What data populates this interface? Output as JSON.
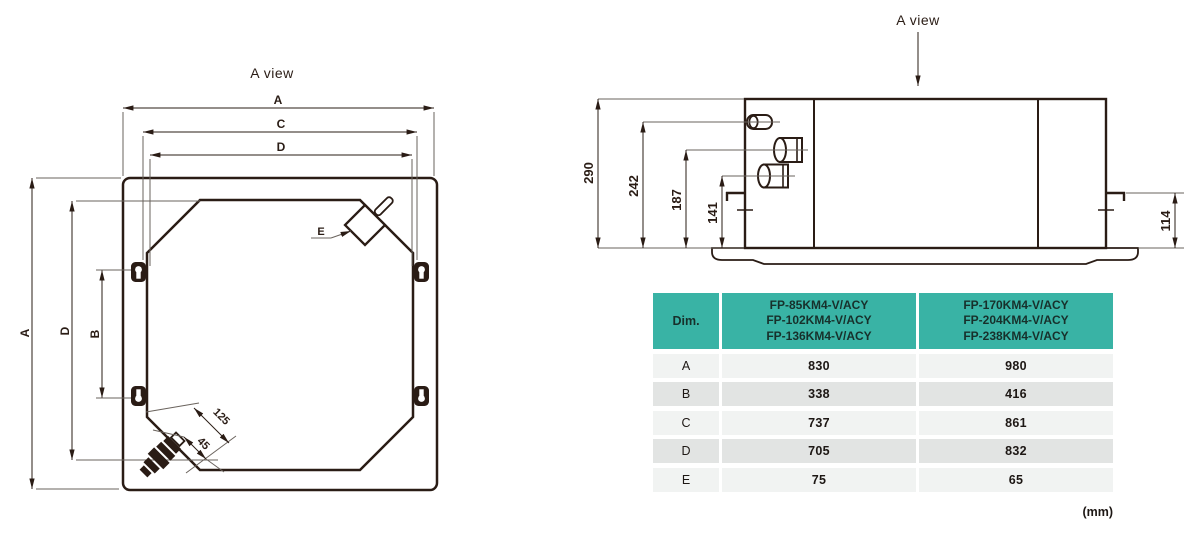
{
  "colors": {
    "line": "#2a1c15",
    "thin": "#6a635d",
    "teal": "#39b3a5",
    "row-light": "#f1f3f2",
    "row-dark": "#e2e4e3"
  },
  "top_view": {
    "title": "A view",
    "dim_a": "A",
    "dim_c": "C",
    "dim_d": "D",
    "dim_b": "B",
    "dim_e": "E",
    "dim_125": "125",
    "dim_45": "45",
    "dim_a_vert": "A",
    "dim_d_vert": "D"
  },
  "side_view": {
    "title": "A view",
    "dim_290": "290",
    "dim_242": "242",
    "dim_187": "187",
    "dim_141": "141",
    "dim_114": "114"
  },
  "table": {
    "header": {
      "dim": "Dim.",
      "col1": [
        "FP-85KM4-V/ACY",
        "FP-102KM4-V/ACY",
        "FP-136KM4-V/ACY"
      ],
      "col2": [
        "FP-170KM4-V/ACY",
        "FP-204KM4-V/ACY",
        "FP-238KM4-V/ACY"
      ]
    },
    "rows": [
      {
        "dim": "A",
        "v1": "830",
        "v2": "980"
      },
      {
        "dim": "B",
        "v1": "338",
        "v2": "416"
      },
      {
        "dim": "C",
        "v1": "737",
        "v2": "861"
      },
      {
        "dim": "D",
        "v1": "705",
        "v2": "832"
      },
      {
        "dim": "E",
        "v1": "75",
        "v2": "65"
      }
    ],
    "unit": "(mm)"
  }
}
